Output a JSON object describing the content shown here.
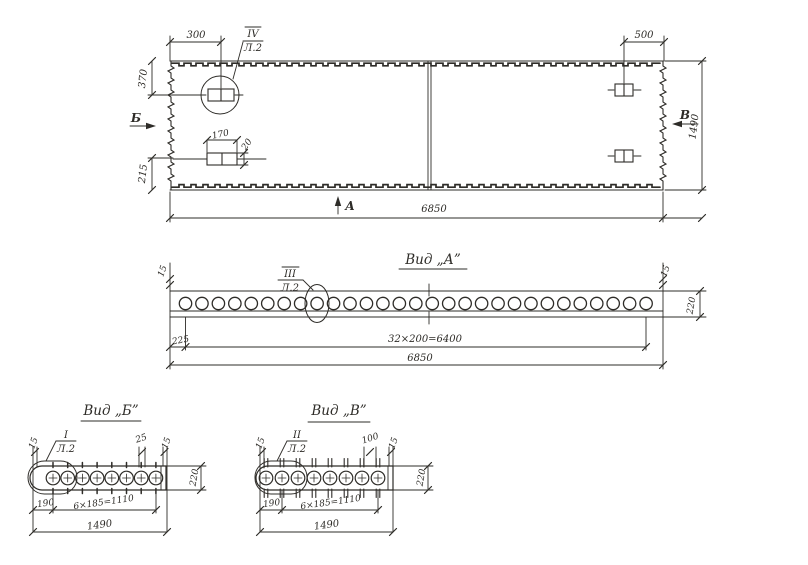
{
  "colors": {
    "ink": "#2e2c28",
    "paper": "#ffffff"
  },
  "plan": {
    "dims": {
      "d300": "300",
      "d500": "500",
      "d370": "370",
      "d215": "215",
      "d170": "170",
      "d20": "20",
      "d1490": "1490",
      "d6850": "6850"
    },
    "sections": {
      "a": "А",
      "b": "Б",
      "v": "В"
    },
    "detail": {
      "num": "IV",
      "sheet": "Л.2"
    }
  },
  "view_a": {
    "title": "Вид „А”",
    "detail": {
      "num": "III",
      "sheet": "Л.2"
    },
    "dims": {
      "d15l": "15",
      "d15r": "15",
      "d220": "220",
      "d225": "225",
      "spacing": "32×200=6400",
      "total": "6850"
    },
    "hole_count": 29
  },
  "view_b": {
    "title": "Вид „Б”",
    "detail": {
      "num": "I",
      "sheet": "Л.2"
    },
    "dims": {
      "d15l": "15",
      "d25": "25",
      "d15r": "15",
      "d220": "220",
      "d190": "190",
      "spacing": "6×185=1110",
      "total": "1490"
    },
    "hole_count": 8
  },
  "view_v": {
    "title": "Вид „В”",
    "detail": {
      "num": "II",
      "sheet": "Л.2"
    },
    "dims": {
      "d15l": "15",
      "d100": "100",
      "d15r": "15",
      "d220": "220",
      "d190": "190",
      "spacing": "6×185=1110",
      "total": "1490"
    },
    "hole_count": 8
  }
}
